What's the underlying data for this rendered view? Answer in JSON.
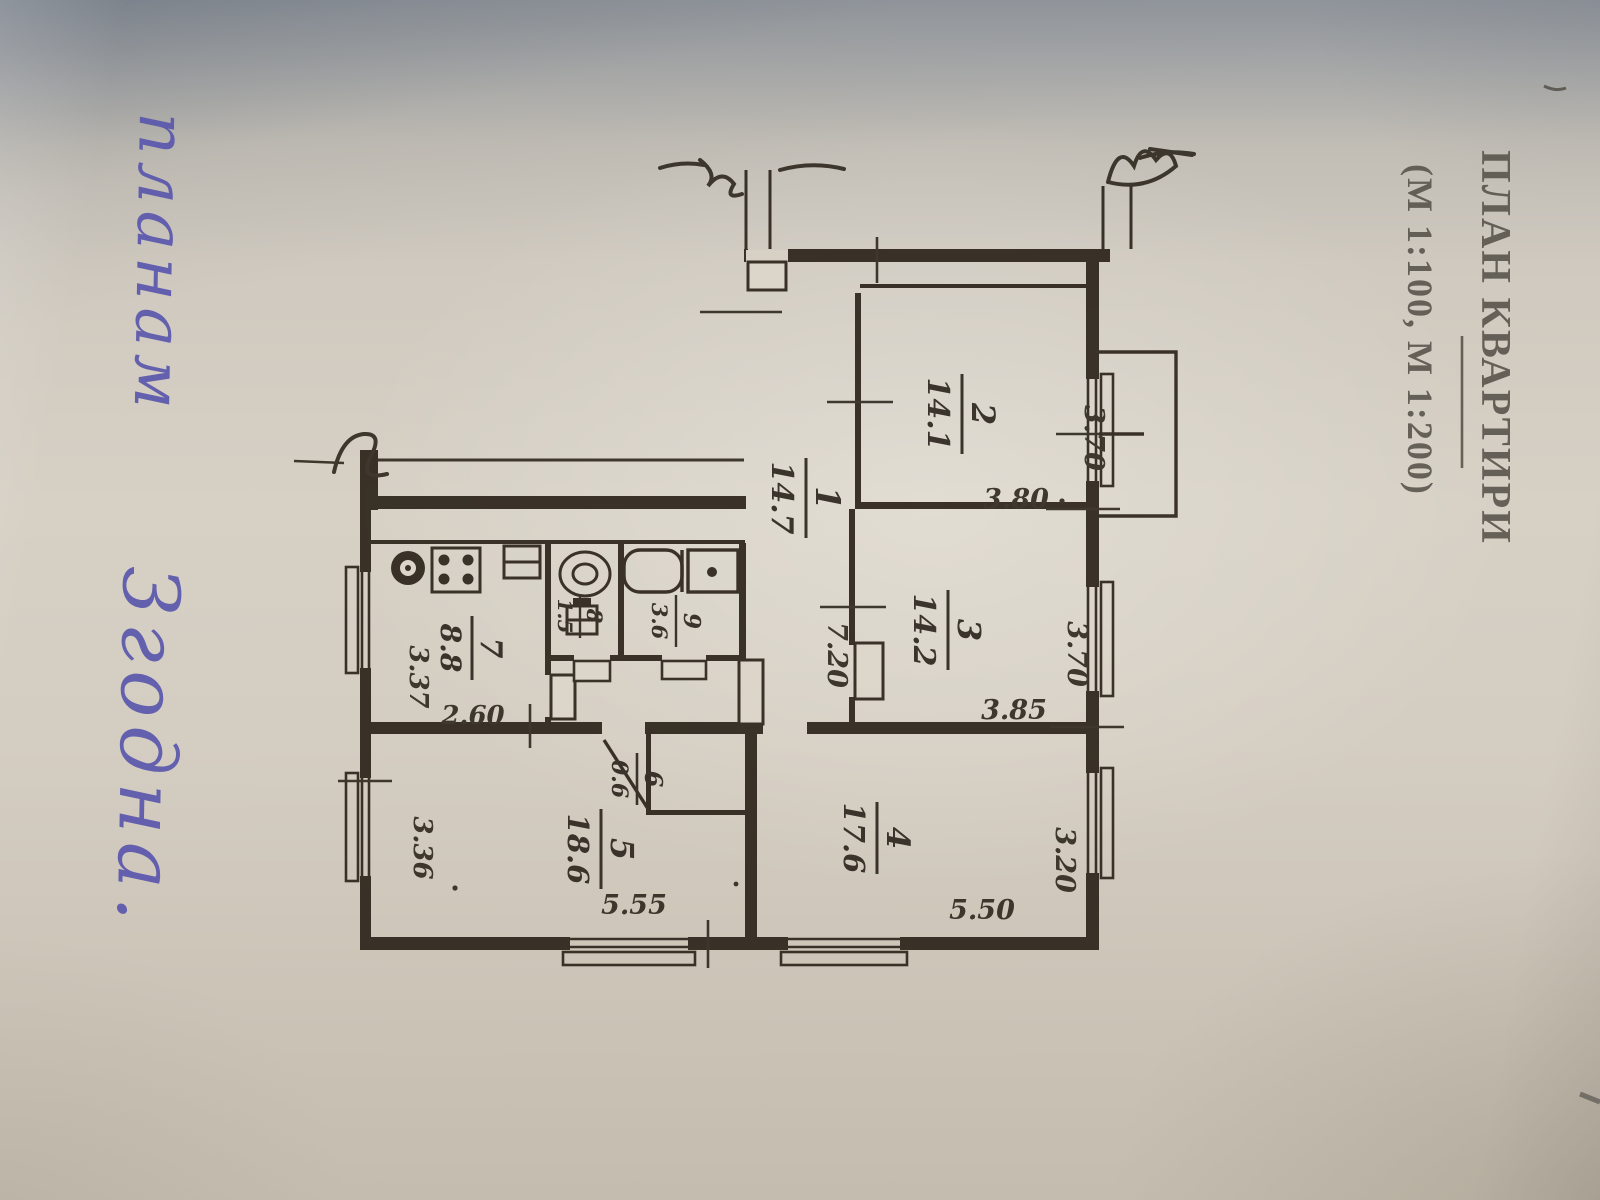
{
  "photo": {
    "title": "ПЛАН КВАРТИРИ",
    "subtitle": "(М 1:100, М 1:200)",
    "handwriting": {
      "word1": "планам",
      "word2": "Згодна."
    },
    "colors": {
      "ink": "#2e261c",
      "pen_ink": "#5a57ad",
      "paper": "#d6d0c5"
    }
  },
  "plan": {
    "rooms": [
      {
        "num": "1",
        "area": "14.7"
      },
      {
        "num": "2",
        "area": "14.1"
      },
      {
        "num": "3",
        "area": "14.2"
      },
      {
        "num": "4",
        "area": "17.6"
      },
      {
        "num": "5",
        "area": "18.6"
      },
      {
        "num": "6",
        "area": "0.6"
      },
      {
        "num": "7",
        "area": "8.8"
      },
      {
        "num": "8",
        "area": "1.5"
      },
      {
        "num": "9",
        "area": "3.6"
      }
    ],
    "dims": {
      "room2_width": "3.70",
      "room2_depth": "3.80",
      "room3_width": "3.70",
      "room3_depth": "3.85",
      "room4_width": "3.20",
      "room4_length": "5.50",
      "room5_length": "5.55",
      "room5_width": "3.36",
      "kitchen_width": "3.37",
      "kitchen_depth": "2.60",
      "hall_length": "7.20"
    }
  }
}
